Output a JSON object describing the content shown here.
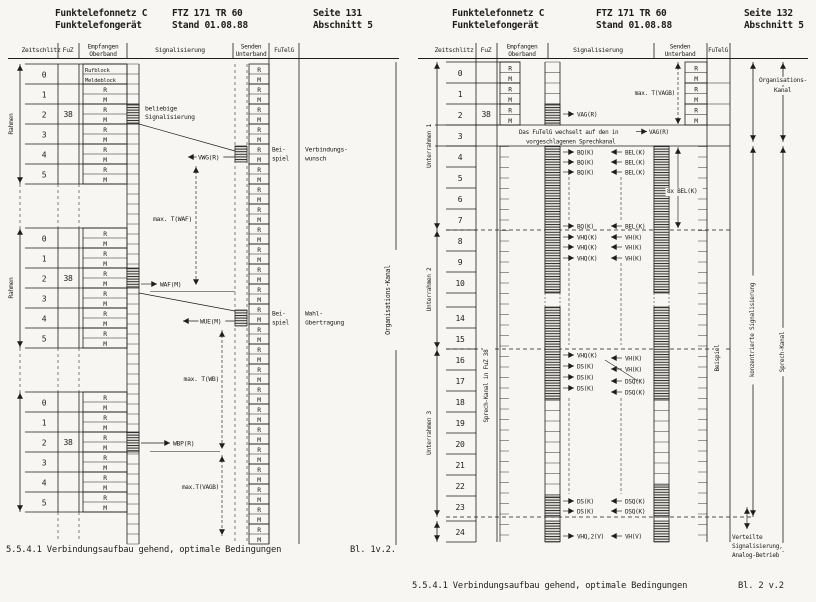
{
  "pages": [
    {
      "id": "page-131",
      "header": {
        "product_line1": "Funktelefonnetz C",
        "product_line2": "Funktelefongerät",
        "spec_line1": "FTZ 171 TR 60",
        "spec_line2": "Stand 01.08.88",
        "page_line1": "Seite 131",
        "page_line2": "Abschnitt 5"
      },
      "columns": {
        "timeslot": "Zeitschlitz",
        "fuz": "FuZ",
        "rx_line1": "Empfangen",
        "rx_line2": "Oberband",
        "signalling": "Signalisierung",
        "tx_line1": "Senden",
        "tx_line2": "Unterband",
        "futelg": "FuTelG"
      },
      "slot_labels": [
        "0",
        "1",
        "2",
        "3",
        "4",
        "5"
      ],
      "fuz_value": "38",
      "cell_r": "R",
      "cell_m": "M",
      "call_block": "Rufblock",
      "message_block": "Meldeblock",
      "frame_label": "Rahmen",
      "org_channel": "Organisations-Kanal",
      "labels": {
        "any_sig_line1": "beliebige",
        "any_sig_line2": "Signalisierung",
        "vwg": "VWG(R)",
        "waf": "WAF(M)",
        "wue": "WUE(M)",
        "wbp": "WBP(R)",
        "t_waf": "max. T(WAF)",
        "t_wb": "max. T(WB)",
        "t_vagb": "max.T(VAGB)",
        "example_line1": "Bei-",
        "example_line2": "spiel",
        "callreq_line1": "Verbindungs-",
        "callreq_line2": "wunsch",
        "dial_line1": "Wahl-",
        "dial_line2": "übertragung"
      },
      "caption": "5.5.4.1 Verbindungsaufbau gehend, optimale Bedingungen",
      "sheet": "Bl. 1v.2."
    },
    {
      "id": "page-132",
      "header": {
        "product_line1": "Funktelefonnetz C",
        "product_line2": "Funktelefongerät",
        "spec_line1": "FTZ 171 TR 60",
        "spec_line2": "Stand 01.08.88",
        "page_line1": "Seite 132",
        "page_line2": "Abschnitt 5"
      },
      "columns": {
        "timeslot": "Zeitschlitz",
        "fuz": "FuZ",
        "rx_line1": "Empfangen",
        "rx_line2": "Oberband",
        "signalling": "Signalisierung",
        "tx_line1": "Senden",
        "tx_line2": "Unterband",
        "futelg": "FuTelG"
      },
      "slot_labels": [
        "0",
        "1",
        "2",
        "3",
        "4",
        "5",
        "6",
        "7",
        "8",
        "9",
        "10",
        "14",
        "15",
        "16",
        "17",
        "18",
        "19",
        "20",
        "21",
        "22",
        "23",
        "24"
      ],
      "fuz_value": "38",
      "cell_r": "R",
      "cell_m": "M",
      "subframe_labels": [
        "Unterrahmen 1",
        "Unterrahmen 2",
        "Unterrahmen 3"
      ],
      "speech_channel_note": "Sprech-Kanal in FuZ 38",
      "labels": {
        "vag": "VAG(R)",
        "switch_line1": "Das FuTelG wechselt auf den in",
        "switch_line2": "vorgeschlagenen Sprechkanal",
        "bq": "BQ(K)",
        "bel": "BEL(K)",
        "bel_8x": "8x BEL(K)",
        "vhq": "VHQ(K)",
        "vh": "VH(K)",
        "ds": "DS(K)",
        "dsq": "DSQ(K)",
        "vhq2": "VHQ,2(V)",
        "vh_v": "VH(V)",
        "t_vagb": "max. T(VAGB)",
        "org_line1": "Organisations-",
        "org_line2": "Kanal",
        "example": "Beispiel",
        "concentrated": "konzentrierte Signalisierung",
        "speech": "Sprech-Kanal",
        "distributed_line1": "Verteilte",
        "distributed_line2": "Signalisierung,",
        "distributed_line3": "Analog-Betrieb"
      },
      "caption": "5.5.4.1 Verbindungsaufbau gehend, optimale Bedingungen",
      "sheet": "Bl. 2 v.2"
    }
  ]
}
